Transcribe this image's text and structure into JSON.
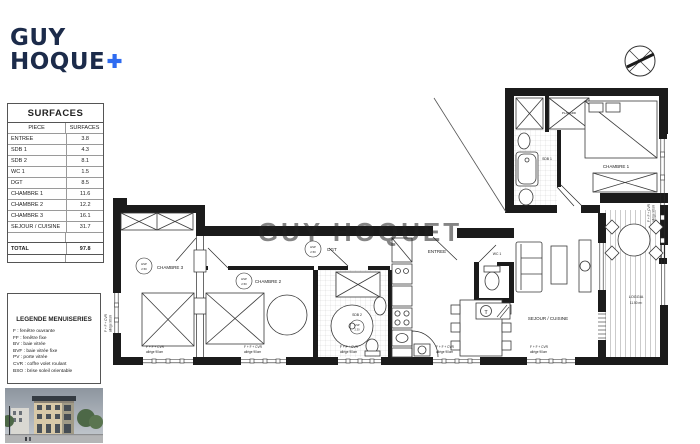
{
  "logo": {
    "line1": "GUY",
    "line2": "HOQUE"
  },
  "surfaces": {
    "title": "SURFACES",
    "col_piece": "PIECE",
    "col_surface": "SURFACES",
    "rows": [
      {
        "piece": "ENTREE",
        "surface": "3.8"
      },
      {
        "piece": "SDB 1",
        "surface": "4.3"
      },
      {
        "piece": "SDB 2",
        "surface": "8.1"
      },
      {
        "piece": "WC 1",
        "surface": "1.5"
      },
      {
        "piece": "DGT",
        "surface": "8.5"
      },
      {
        "piece": "CHAMBRE 1",
        "surface": "11.6"
      },
      {
        "piece": "CHAMBRE 2",
        "surface": "12.2"
      },
      {
        "piece": "CHAMBRE 3",
        "surface": "16.1"
      },
      {
        "piece": "SEJOUR / CUISINE",
        "surface": "31.7"
      }
    ],
    "total_label": "TOTAL",
    "total_value": "97.8"
  },
  "legend": {
    "title": "LEGENDE MENUISERIES",
    "items": [
      "F : fenêtre ouvrante",
      "FF : fenêtre fixe",
      "BV : baie vitrée",
      "BVF : baie vitrée fixe",
      "PV : porte vitrée",
      "CVR : coffre volet roulant",
      "BSO : brise soleil orientable"
    ]
  },
  "plan": {
    "rooms": {
      "chambre1": "CHAMBRE 1",
      "chambre2": "CHAMBRE 2",
      "chambre3": "CHAMBRE 3",
      "sdb1": "SDB 1",
      "sdb2": "SDB 2",
      "wc1": "WC 1",
      "dgt": "DGT",
      "entree": "ENTREE",
      "sejour": "SEJOUR / CUISINE",
      "loggia": "LOGGIA",
      "loggia_area": "11.50 m²",
      "placard": "PLACARD"
    },
    "hsp": {
      "label": "HSP",
      "h250": "2.50",
      "h230": "2.30"
    },
    "window_label": {
      "l1": "F + F + CVR",
      "l2": "allège 90cm"
    },
    "t_symbol": "T",
    "watermark": "GUY HOQUET"
  }
}
